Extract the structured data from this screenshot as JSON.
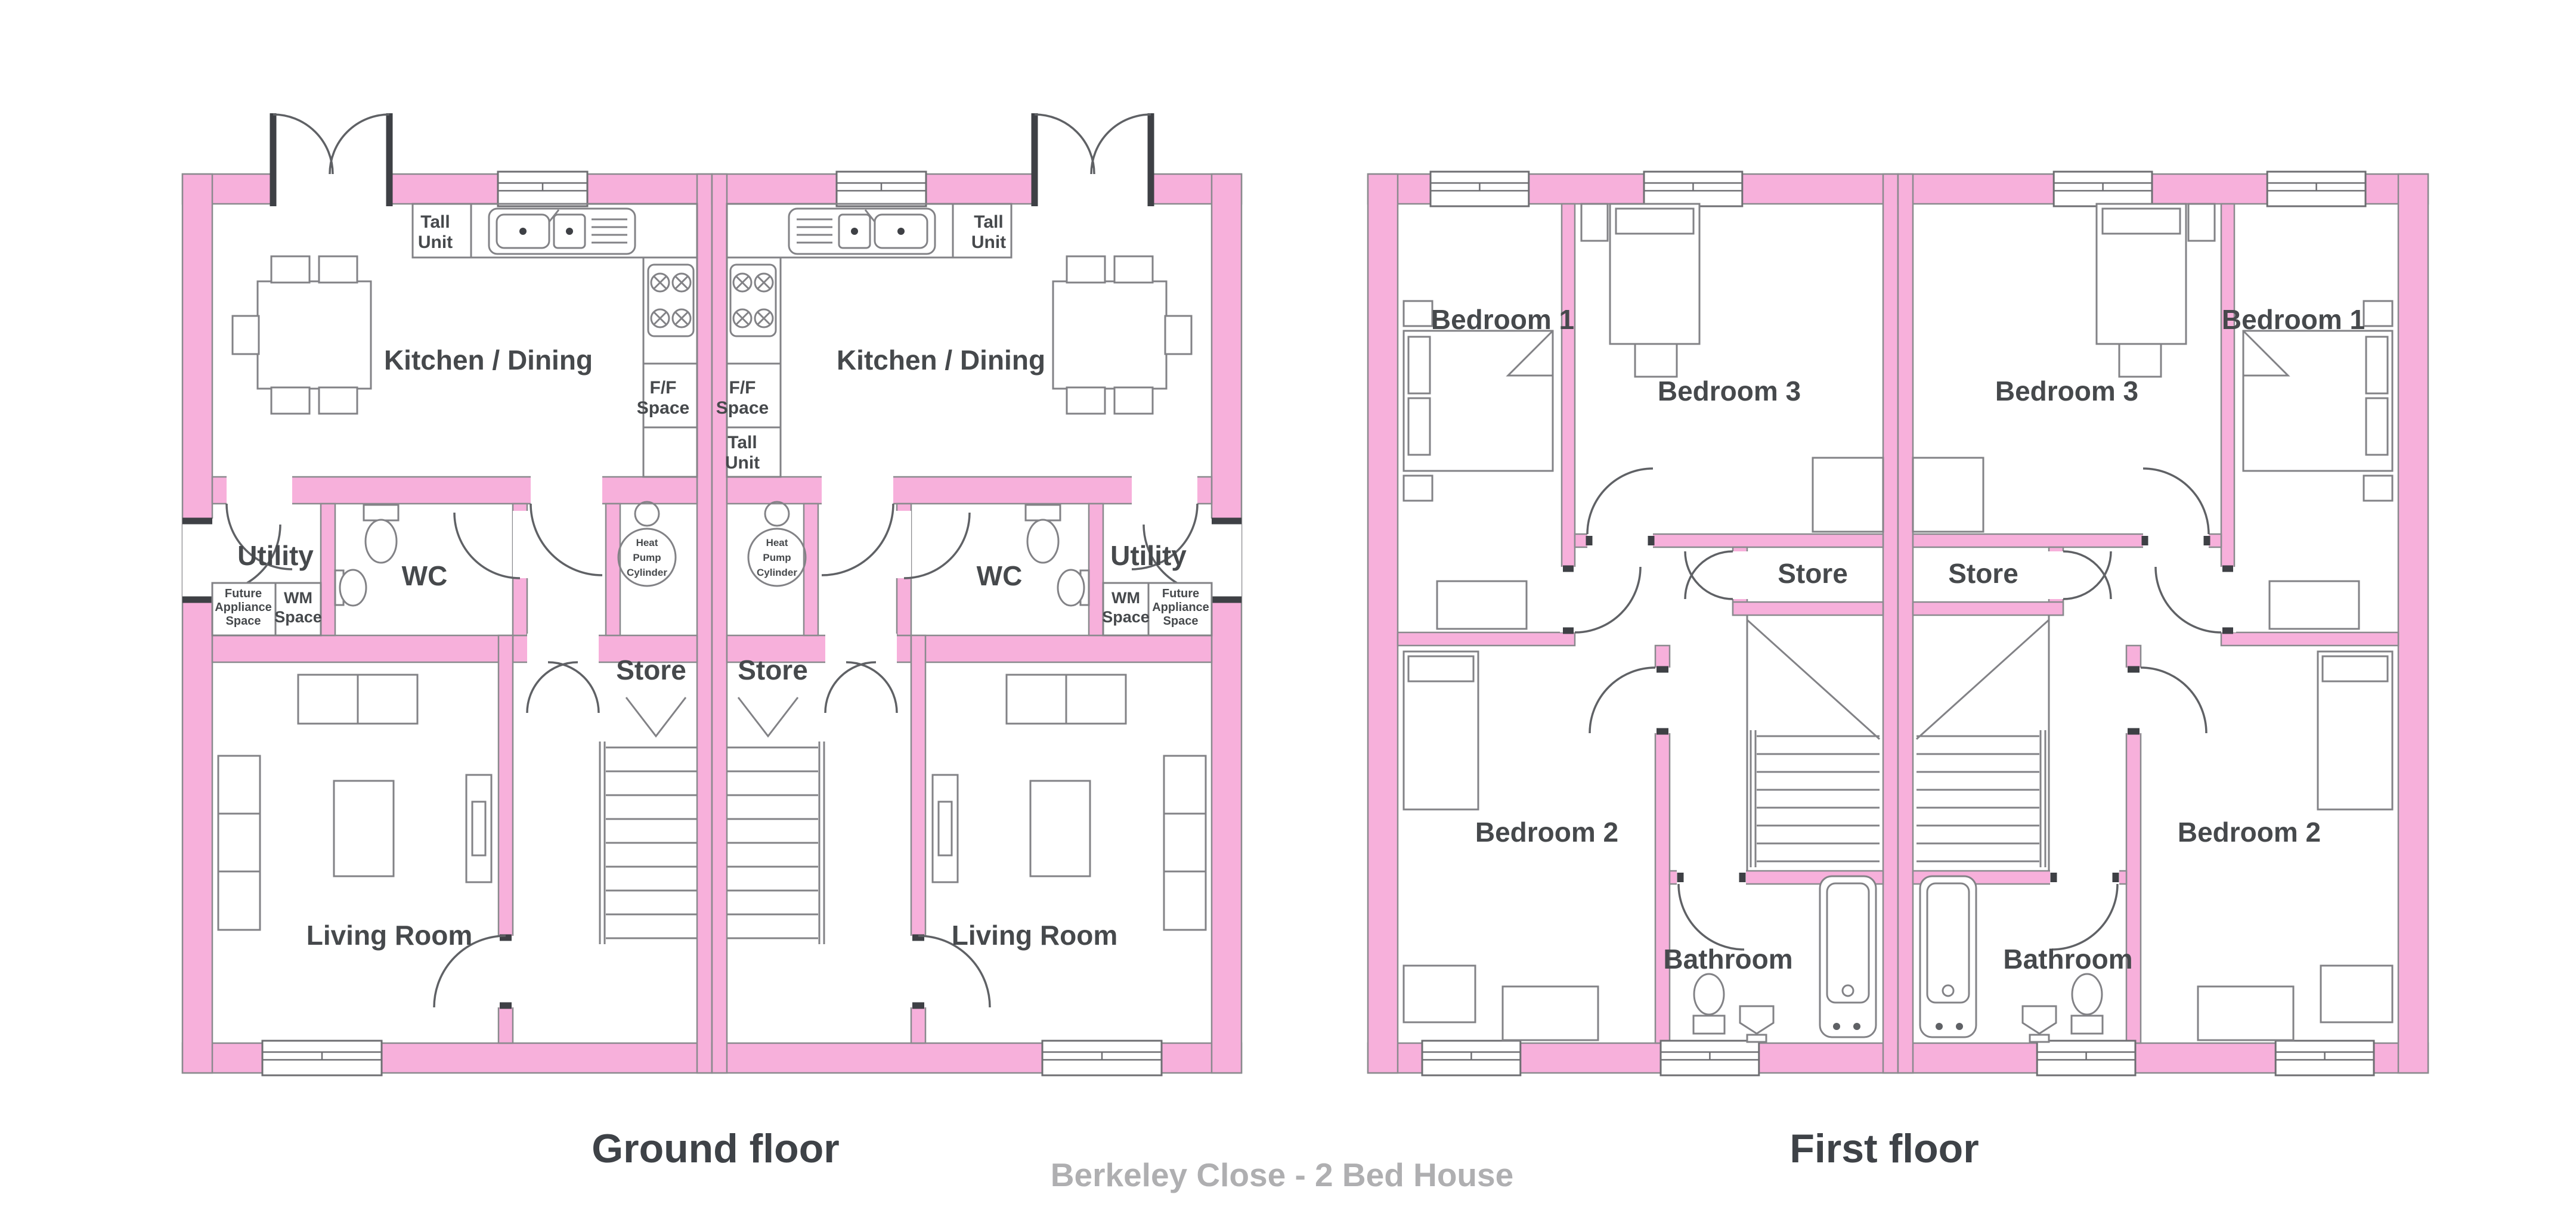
{
  "titles": {
    "ground_floor": "Ground floor",
    "first_floor": "First floor",
    "footer": "Berkeley Close - 2 Bed House"
  },
  "ground": {
    "kitchen_dining": "Kitchen / Dining",
    "tall_unit": [
      "Tall",
      "Unit"
    ],
    "ff_space": [
      "F/F",
      "Space"
    ],
    "utility": "Utility",
    "wc": "WC",
    "future_appliance": [
      "Future",
      "Appliance",
      "Space"
    ],
    "wm_space": [
      "WM",
      "Space"
    ],
    "heat_pump": [
      "Heat",
      "Pump",
      "Cylinder"
    ],
    "store": "Store",
    "living_room": "Living Room"
  },
  "first": {
    "bedroom1": "Bedroom 1",
    "bedroom2": "Bedroom 2",
    "bedroom3": "Bedroom 3",
    "store": "Store",
    "bathroom": "Bathroom"
  },
  "colors": {
    "wall_pink": "#F7B0DB",
    "wall_edge": "#8A8A8E",
    "door_jamb": "#3E4045",
    "label_gray": "#46494C",
    "title_gray": "#3E4247",
    "footer_gray": "#AFAFB1",
    "background": "#FFFFFF"
  }
}
